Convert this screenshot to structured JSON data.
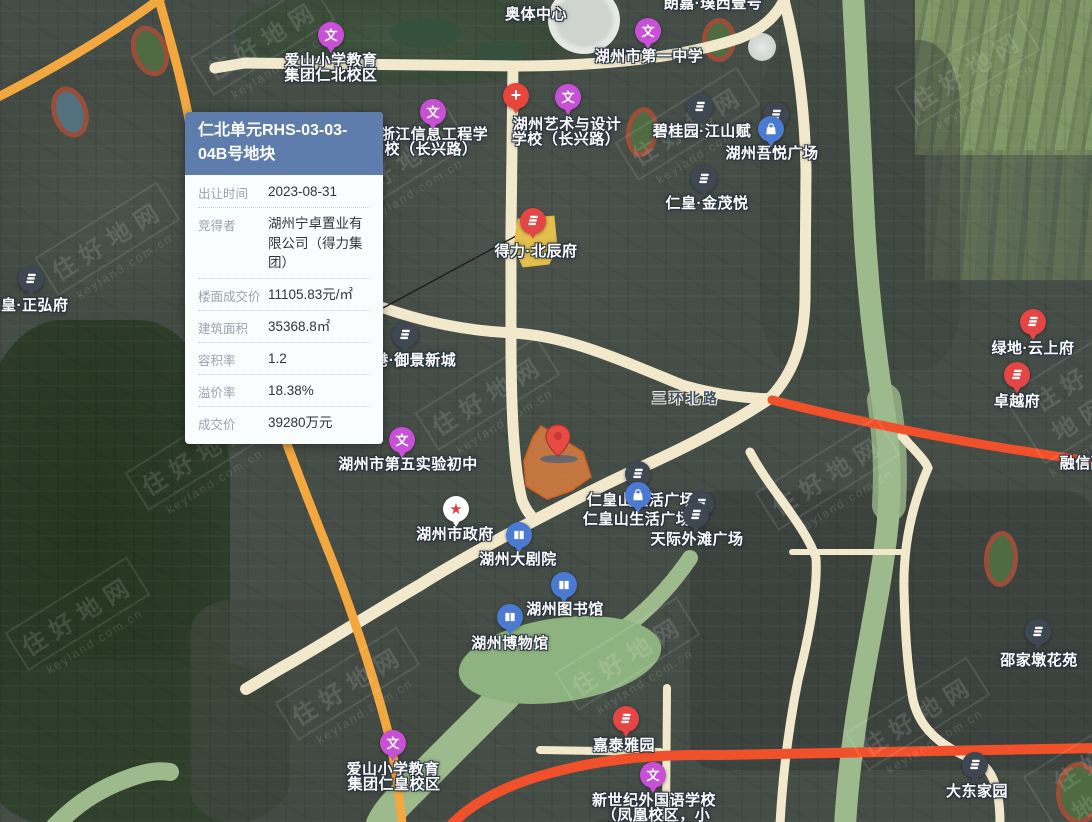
{
  "info_card": {
    "title": "仁北单元RHS-03-03-04B号地块",
    "rows": [
      {
        "label": "出让时间",
        "value": "2023-08-31"
      },
      {
        "label": "竞得者",
        "value": "湖州宁卓置业有限公司（得力集团）"
      },
      {
        "label": "楼面成交价",
        "value": "11105.83元/㎡"
      },
      {
        "label": "建筑面积",
        "value": "35368.8㎡"
      },
      {
        "label": "容积率",
        "value": "1.2"
      },
      {
        "label": "溢价率",
        "value": "18.38%"
      },
      {
        "label": "成交价",
        "value": "39280万元"
      }
    ]
  },
  "map": {
    "road_labels": [
      {
        "text": "三环北路",
        "x": 686,
        "y": 388
      }
    ],
    "pois": [
      {
        "name": "aoti-center",
        "icon": null,
        "lines": [
          {
            "t": "奥体中心",
            "x": 536,
            "y": 3
          }
        ]
      },
      {
        "name": "langjia-puxi-no1",
        "icon": null,
        "lines": [
          {
            "t": "朗嘉·璞西壹号",
            "x": 713,
            "y": -8
          }
        ]
      },
      {
        "name": "aishan-primary-renbei",
        "icon": "school",
        "ix": 331,
        "iy": 35,
        "lines": [
          {
            "t": "爱山小学教育",
            "x": 331,
            "y": 49
          },
          {
            "t": "集团仁北校区",
            "x": 331,
            "y": 64
          }
        ]
      },
      {
        "name": "huzhou-no1-middle-school",
        "icon": "school",
        "ix": 648,
        "iy": 31,
        "lines": [
          {
            "t": "湖州市第一中学",
            "x": 649,
            "y": 45
          }
        ]
      },
      {
        "name": "hospital",
        "icon": "hospital",
        "ix": 516,
        "iy": 96,
        "lines": []
      },
      {
        "name": "huzhou-art-design-school",
        "icon": "school",
        "ix": 568,
        "iy": 97,
        "lines": [
          {
            "t": "湖州艺术与设计",
            "x": 567,
            "y": 113
          },
          {
            "t": "学校（长兴路）",
            "x": 566,
            "y": 128
          }
        ]
      },
      {
        "name": "zhejiang-info-eng-school",
        "icon": "school",
        "ix": 433,
        "iy": 112,
        "lines": [
          {
            "t": "浙江信息工程学",
            "x": 434,
            "y": 123
          },
          {
            "t": "校（长兴路）",
            "x": 431,
            "y": 138
          }
        ]
      },
      {
        "name": "biguiyuan-jiangshanfu",
        "icon": "residence",
        "ix": 700,
        "iy": 107,
        "lines": [
          {
            "t": "碧桂园·江山赋",
            "x": 702,
            "y": 120
          }
        ]
      },
      {
        "name": "wuyue-plaza-residence",
        "icon": "residence",
        "ix": 776,
        "iy": 115,
        "lines": []
      },
      {
        "name": "huzhou-wuyue-plaza",
        "icon": "mall",
        "ix": 771,
        "iy": 129,
        "lines": [
          {
            "t": "湖州吾悦广场",
            "x": 772,
            "y": 142
          }
        ]
      },
      {
        "name": "renhuang-jinmaoyue",
        "icon": "residence",
        "ix": 704,
        "iy": 179,
        "lines": [
          {
            "t": "仁皇·金茂悦",
            "x": 707,
            "y": 192
          }
        ]
      },
      {
        "name": "deli-beichenfu",
        "icon": "residence-red",
        "ix": 533,
        "iy": 221,
        "lines": [
          {
            "t": "得力·北辰府",
            "x": 536,
            "y": 240
          }
        ]
      },
      {
        "name": "renhuang-zhenghongfu",
        "icon": "residence",
        "ix": 31,
        "iy": 279,
        "lines": [
          {
            "t": "仁皇·正弘府",
            "x": 27,
            "y": 294
          }
        ]
      },
      {
        "name": "dagang-yujing-xincheng",
        "icon": "residence",
        "ix": 405,
        "iy": 335,
        "lines": [
          {
            "t": "大港·御景新城",
            "x": 407,
            "y": 349
          }
        ]
      },
      {
        "name": "lvdi-yunshangfu",
        "icon": "residence-red",
        "ix": 1033,
        "iy": 322,
        "lines": [
          {
            "t": "绿地·云上府",
            "x": 1033,
            "y": 337
          }
        ]
      },
      {
        "name": "zhuoyuefu",
        "icon": "residence-red",
        "ix": 1017,
        "iy": 375,
        "lines": [
          {
            "t": "卓越府",
            "x": 1017,
            "y": 390
          }
        ]
      },
      {
        "name": "rongxin",
        "icon": null,
        "lines": [
          {
            "t": "融信融",
            "x": 1083,
            "y": 452
          }
        ]
      },
      {
        "name": "huzhou-no5-experimental",
        "icon": "school",
        "ix": 402,
        "iy": 440,
        "lines": [
          {
            "t": "湖州市第五实验初中",
            "x": 408,
            "y": 453
          }
        ]
      },
      {
        "name": "huzhou-city-government",
        "icon": "government",
        "ix": 456,
        "iy": 509,
        "lines": [
          {
            "t": "湖州市政府",
            "x": 455,
            "y": 523
          }
        ]
      },
      {
        "name": "huzhou-grand-theatre",
        "icon": "culture",
        "ix": 519,
        "iy": 535,
        "lines": [
          {
            "t": "湖州大剧院",
            "x": 518,
            "y": 548
          }
        ]
      },
      {
        "name": "renhuangshan-plaza-residence",
        "icon": "residence",
        "ix": 638,
        "iy": 474,
        "lines": []
      },
      {
        "name": "renhuangshan-life-plaza",
        "icon": "mall",
        "ix": 638,
        "iy": 495,
        "lines": [
          {
            "t": "仁皇山生活广场",
            "x": 641,
            "y": 489
          }
        ]
      },
      {
        "name": "renhuangshan-life-plaza-2",
        "icon": "residence",
        "ix": 701,
        "iy": 504,
        "lines": [
          {
            "t": "仁皇山生活广场",
            "x": 637,
            "y": 508
          }
        ]
      },
      {
        "name": "renhuangshan-life-plaza-2b",
        "icon": "residence",
        "ix": 696,
        "iy": 515,
        "lines": []
      },
      {
        "name": "tianji-waitan-plaza",
        "icon": null,
        "lines": [
          {
            "t": "天际外滩广场",
            "x": 697,
            "y": 528
          }
        ]
      },
      {
        "name": "huzhou-library",
        "icon": "culture",
        "ix": 564,
        "iy": 585,
        "lines": [
          {
            "t": "湖州图书馆",
            "x": 565,
            "y": 598
          }
        ]
      },
      {
        "name": "huzhou-museum",
        "icon": "culture",
        "ix": 510,
        "iy": 617,
        "lines": [
          {
            "t": "湖州博物馆",
            "x": 510,
            "y": 632
          }
        ]
      },
      {
        "name": "shaojiadun-huayuan",
        "icon": "residence",
        "ix": 1038,
        "iy": 632,
        "lines": [
          {
            "t": "邵家墩花苑",
            "x": 1039,
            "y": 649
          }
        ]
      },
      {
        "name": "jiatai-yayuan",
        "icon": "residence-red",
        "ix": 626,
        "iy": 719,
        "lines": [
          {
            "t": "嘉泰雅园",
            "x": 624,
            "y": 734
          }
        ]
      },
      {
        "name": "aishan-primary-renhuang",
        "icon": "school",
        "ix": 393,
        "iy": 743,
        "lines": [
          {
            "t": "爱山小学教育",
            "x": 393,
            "y": 758
          },
          {
            "t": "集团仁皇校区",
            "x": 394,
            "y": 773
          }
        ]
      },
      {
        "name": "new-century-foreign-school",
        "icon": "school",
        "ix": 653,
        "iy": 775,
        "lines": [
          {
            "t": "新世纪外国语学校",
            "x": 654,
            "y": 789
          },
          {
            "t": "（凤凰校区，小",
            "x": 656,
            "y": 804
          },
          {
            "t": "学部、初中部）",
            "x": 650,
            "y": 819
          }
        ]
      },
      {
        "name": "dadong-jiayuan",
        "icon": "residence",
        "ix": 975,
        "iy": 765,
        "lines": [
          {
            "t": "大东家园",
            "x": 977,
            "y": 780
          }
        ]
      }
    ],
    "watermark": {
      "logo": "住好地网",
      "domain": "keyland.com.cn",
      "tiles": [
        [
          40,
          215
        ],
        [
          330,
          140
        ],
        [
          620,
          100
        ],
        [
          900,
          45
        ],
        [
          130,
          430
        ],
        [
          420,
          370
        ],
        [
          760,
          450
        ],
        [
          1020,
          360
        ],
        [
          10,
          590
        ],
        [
          280,
          660
        ],
        [
          560,
          630
        ],
        [
          850,
          690
        ],
        [
          1040,
          740
        ],
        [
          195,
          15
        ]
      ]
    }
  },
  "colors": {
    "card_header": "#5e7cac",
    "selected_parcel": "#e8813f",
    "sold_parcel": "#f2c94e",
    "school_icon": "#c750d6",
    "mall_icon": "#4a7ad2",
    "residence_icon": "#3f4752",
    "red_icon": "#e64545",
    "highway": "#f1512a",
    "road": "#f2e9cc",
    "river": "#9cba8c"
  }
}
